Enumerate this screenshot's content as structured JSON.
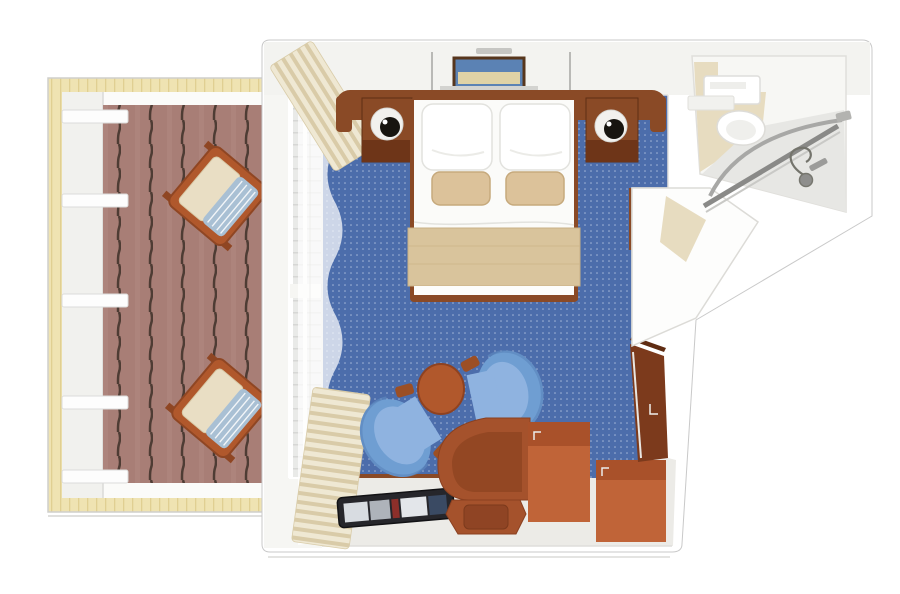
{
  "scene": {
    "title": "Cruise ship stateroom with balcony - 3D top-down floor plan",
    "view": "top-down 3D render",
    "visible_text": []
  },
  "canvas": {
    "width": 900,
    "height": 594,
    "background": "#ffffff"
  },
  "rooms": [
    {
      "id": "balcony",
      "label": "Balcony",
      "features": [
        "timber surround",
        "striped teak decking",
        "white parapet wall",
        "5 railing posts",
        "2 wooden deck chairs with cushions and striped pillows"
      ]
    },
    {
      "id": "stateroom",
      "label": "Stateroom",
      "features": [
        "curved headboard",
        "double bed with white duvet and beige runner",
        "2 white pillows",
        "2 beige accent pillows",
        "2 nightstands with round lamps",
        "framed wall art with shelf",
        "2 hanging reading lights",
        "window wall with sheer curtain",
        "2 striped drapes",
        "2 blue tub chairs",
        "round side table",
        "magazine tray",
        "quarter-round desk",
        "stool",
        "2 drawer units",
        "angled wardrobe"
      ]
    },
    {
      "id": "bathroom",
      "label": "Bathroom",
      "features": [
        "vanity with sink",
        "toilet",
        "curved shower rod",
        "shower glass panel",
        "hand shower with hose",
        "beige tile floor"
      ]
    },
    {
      "id": "entry",
      "label": "Entry nook",
      "features": [
        "beige threshold floor",
        "angled corridor walls"
      ]
    }
  ],
  "colors": {
    "page_bg": "#ffffff",
    "outline": "#c9c9c9",
    "wall_white": "#ffffff",
    "wall_tint": "#f3f3f0",
    "balcony_wood": "#efe3b2",
    "wood_grain": "#e0cf92",
    "deck_base": "#a87e76",
    "deck_stripe": "#4e3c34",
    "railing": "#fdfdfd",
    "carpet_blue": "#4c6dab",
    "carpet_dot": "#a3b7d8",
    "furniture_wood": "#8a4a26",
    "furniture_wood_dark": "#6e3518",
    "orange_bright": "#c06438",
    "orange_mid": "#a5522c",
    "orange_dark": "#7c3a1c",
    "bed_white": "#fbfbf9",
    "pillow_white": "#ffffff",
    "accent_beige": "#dcc29a",
    "blanket_beige": "#d9c49c",
    "cushion_beige": "#e9dec4",
    "pillow_stripe_blue": "#a9c0d4",
    "chair_blue": "#6f9ed2",
    "chair_blue_light": "#8fb3e0",
    "chair_wood": "#9c4f24",
    "bath_tile": "#e7dcc0",
    "shower_gray": "#e7e7e4",
    "fixture_gray": "#a8a8a6",
    "glass_gray": "#8a8a88",
    "tray_dark": "#26262b",
    "valance_light": "#efe8d3",
    "valance_dark": "#d9cba8"
  }
}
